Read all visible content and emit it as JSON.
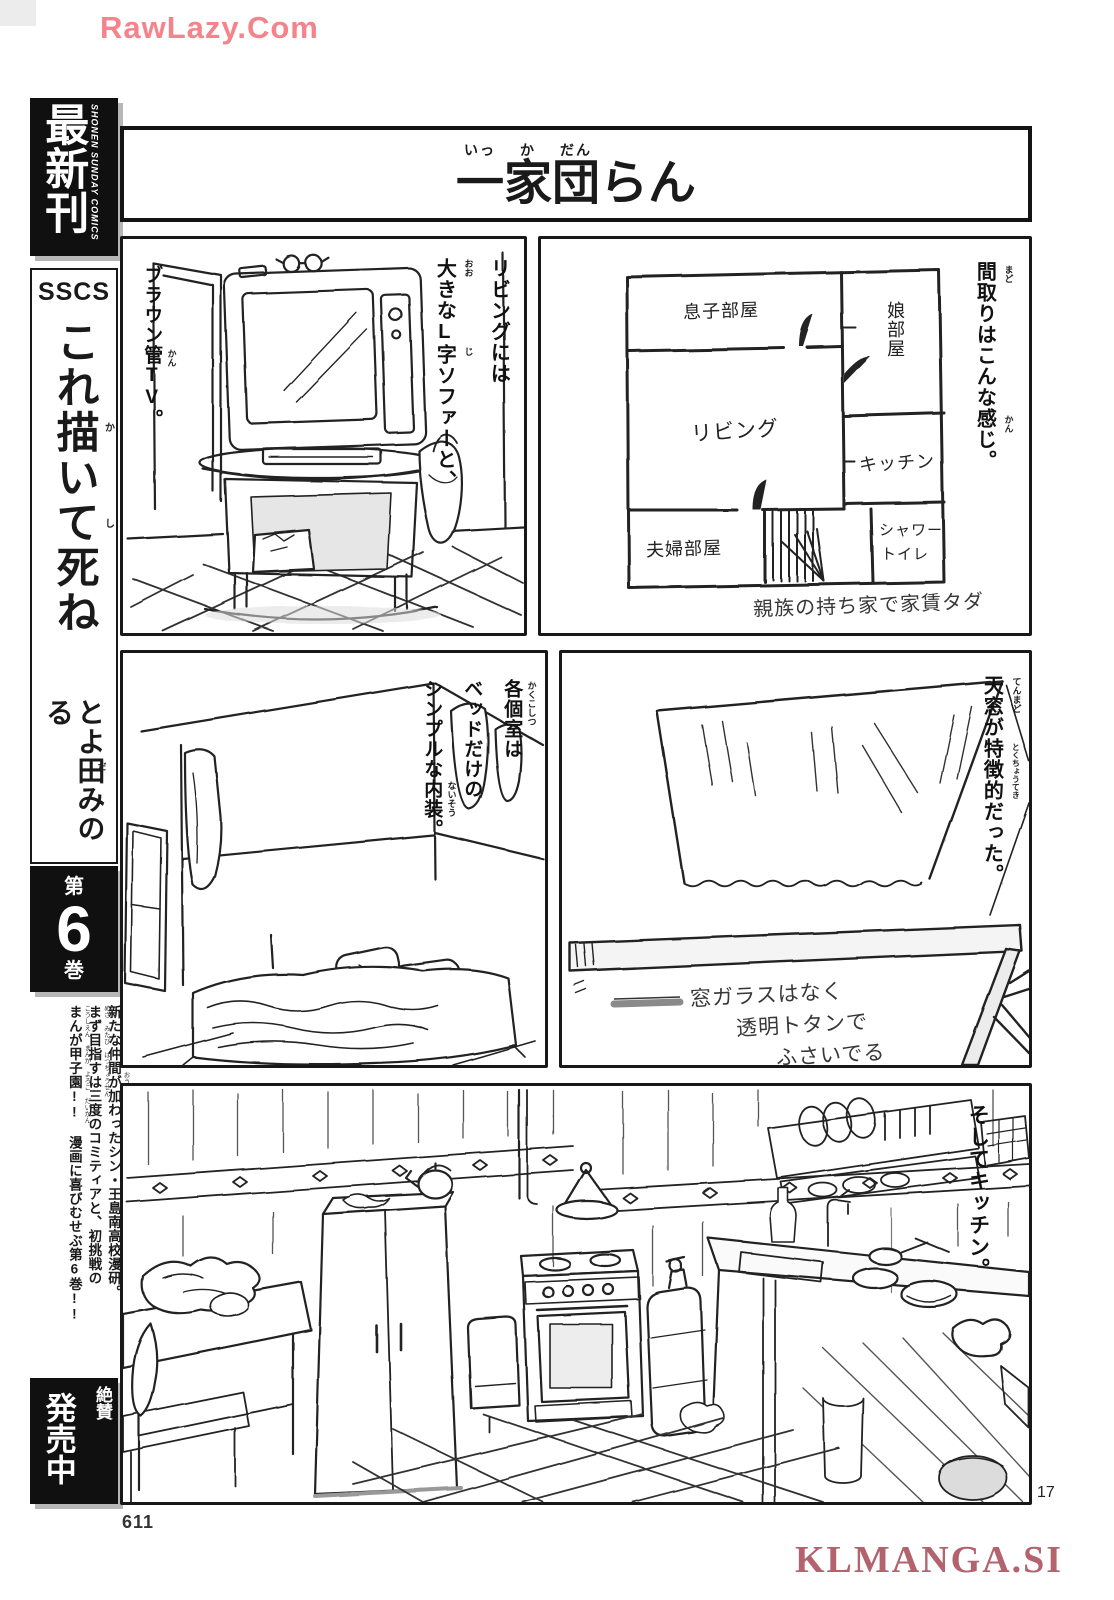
{
  "watermarks": {
    "top": "RawLazy.Com",
    "bottom": "KLMANGA.SI"
  },
  "page": {
    "folio": "611",
    "page_number": "17"
  },
  "sidebar": {
    "banner": {
      "label": "最新刊",
      "imprint": "SHONEN SUNDAY COMICS"
    },
    "series_code": "SSCS",
    "book_title": "これ描いて死ね",
    "book_title_furigana": {
      "kaku": "か",
      "shi": "し"
    },
    "author": "とよ田みのる",
    "author_furigana": "だ",
    "volume": {
      "prefix": "第",
      "number": "6",
      "suffix": "巻"
    },
    "blurb": [
      {
        "text": "新たな仲間が加わったシン・王島南高校漫研。",
        "furigana": "あら なかま くわ おうしまみなみこうこうまんけん"
      },
      {
        "text": "まず目指すは三度のコミティアと、初挑戦の",
        "furigana": "めざ みたび はつちょうせん"
      },
      {
        "text": "まんが甲子園!! 漫画に喜びむせぶ第6巻!!",
        "furigana": "こうしえん まんが よろこ だいかん"
      }
    ],
    "on_sale": {
      "small": "絶賛",
      "large": "発売中"
    }
  },
  "title": {
    "chars": [
      {
        "c": "一",
        "f": "いっ"
      },
      {
        "c": "家",
        "f": "か"
      },
      {
        "c": "団",
        "f": "だん"
      },
      {
        "c": "ら",
        "f": ""
      },
      {
        "c": "ん",
        "f": ""
      }
    ]
  },
  "panels": {
    "tv": {
      "caption_left": "ブラウン管TV。",
      "caption_left_furigana": "かん",
      "caption_right_1": "リビングには",
      "caption_right_2": "大きなL字ソファーと、",
      "fg_oo": "おお",
      "fg_ji": "じ"
    },
    "floorplan": {
      "caption": "間取りはこんな感じ。",
      "fg_mado": "まど",
      "fg_kan": "かん",
      "rooms": {
        "son": "息子部屋",
        "daughter": "娘部屋",
        "living": "リビング",
        "kitchen": "キッチン",
        "couple": "夫婦部屋",
        "shower_1": "シャワー",
        "shower_2": "トイレ"
      },
      "note": "親族の持ち家で家賃タダ"
    },
    "bedroom": {
      "caption_1": "各個室は",
      "caption_2": "ベッドだけの",
      "caption_3": "シンプルな内装。",
      "fg_kakukoshitsu": "かくこしつ",
      "fg_naisou": "ないそう"
    },
    "skylight": {
      "caption": "天窓が特徴的だった。",
      "fg_tenmado": "てんまど",
      "fg_tokuchouteki": "とくちょうてき",
      "note_1": "窓ガラスはなく",
      "note_2": "透明トタンで",
      "note_3": "ふさいでる"
    },
    "kitchen": {
      "caption": "そしてキッチン。"
    }
  }
}
